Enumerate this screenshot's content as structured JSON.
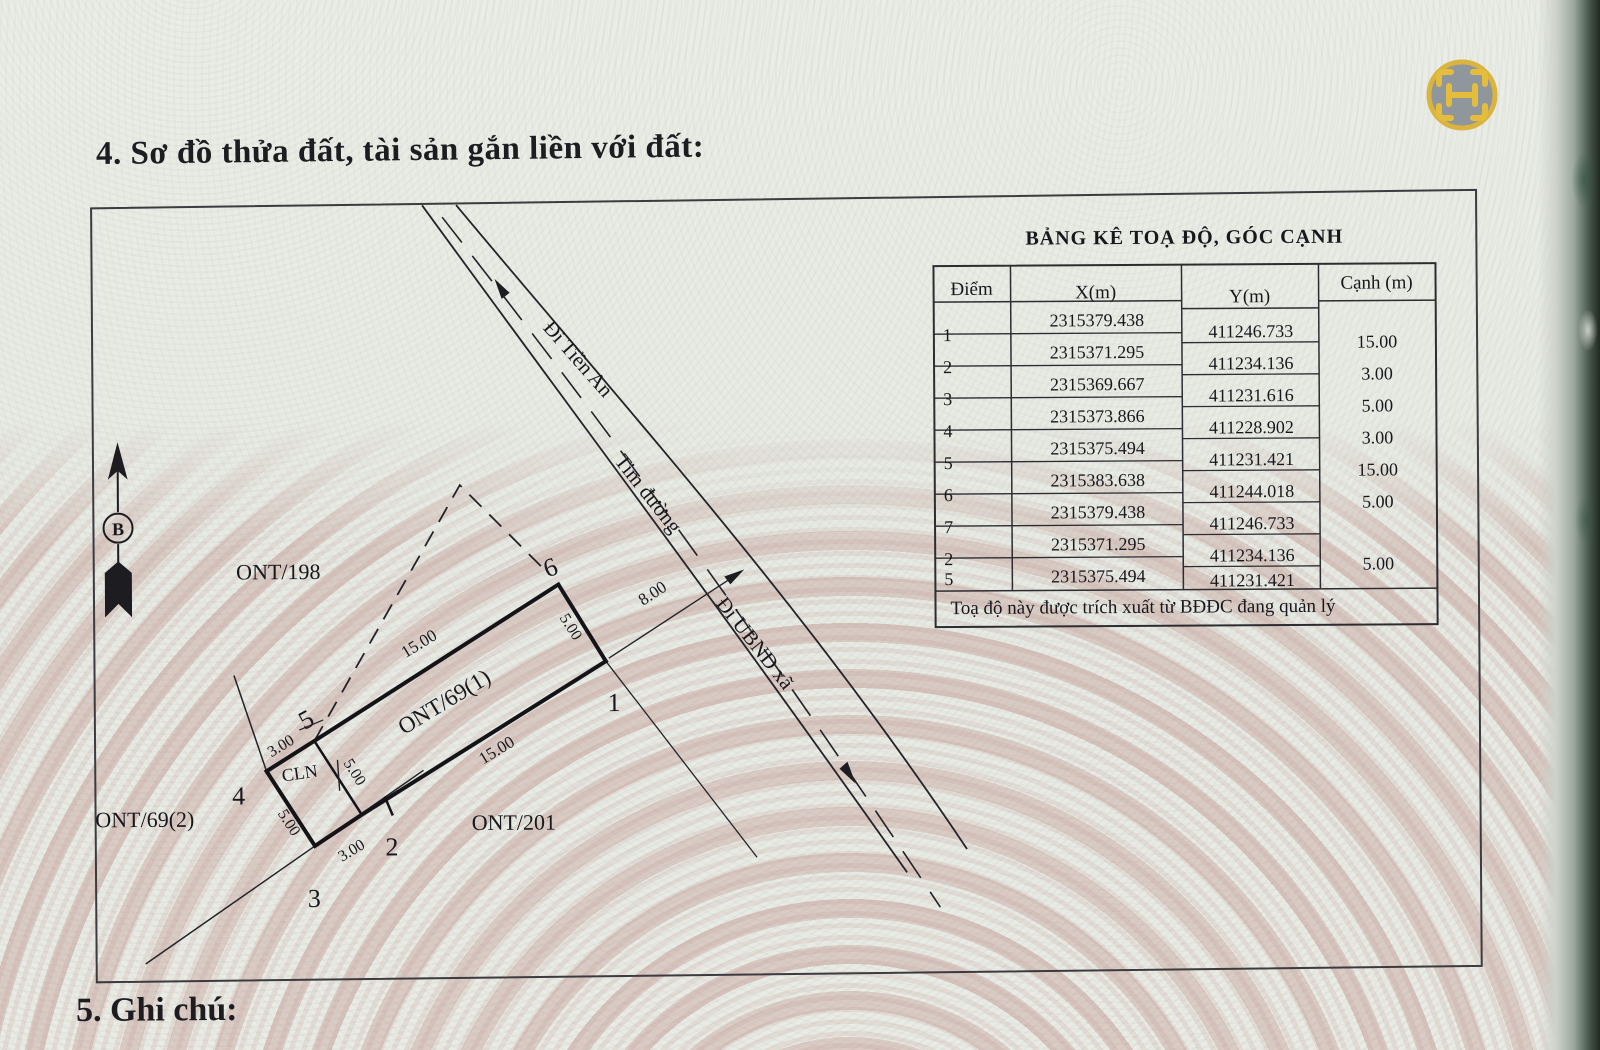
{
  "page": {
    "section4_title": "4. Sơ đồ thửa đất, tài sản gắn liền với đất:",
    "section5_title": "5. Ghi chú:"
  },
  "logo": {
    "glyph_name": "scan-frame-H"
  },
  "compass": {
    "north_label": "B"
  },
  "diagram": {
    "parcels": {
      "ont198": "ONT/198",
      "ont69_1": "ONT/69(1)",
      "ont69_2": "ONT/69(2)",
      "ont201": "ONT/201",
      "cln": "CLN"
    },
    "roads": {
      "di_tien_an": "Đi Tiền An",
      "tim_duong": "Tim đường",
      "di_ubnd_xa": "Đi UBND xã"
    },
    "dims": {
      "side_5_6": "15.00",
      "side_1_2": "15.00",
      "side_6_1": "5.00",
      "side_2_5": "5.00",
      "side_3_4": "5.00",
      "side_4_5": "3.00",
      "side_2_3": "3.00",
      "setback": "8.00"
    },
    "vertices": {
      "v1": "1",
      "v2": "2",
      "v3": "3",
      "v4": "4",
      "v5": "5",
      "v6": "6"
    }
  },
  "table": {
    "title": "BẢNG KÊ TOẠ ĐỘ, GÓC CẠNH",
    "columns": [
      "Điểm",
      "X(m)",
      "Y(m)",
      "Cạnh (m)"
    ],
    "rows": [
      {
        "diem": "1",
        "x": "2315379.438",
        "y": "411246.733"
      },
      {
        "diem": "2",
        "x": "2315371.295",
        "y": "411234.136"
      },
      {
        "diem": "3",
        "x": "2315369.667",
        "y": "411231.616"
      },
      {
        "diem": "4",
        "x": "2315373.866",
        "y": "411228.902"
      },
      {
        "diem": "5",
        "x": "2315375.494",
        "y": "411231.421"
      },
      {
        "diem": "6",
        "x": "2315383.638",
        "y": "411244.018"
      },
      {
        "diem": "7",
        "x": "2315379.438",
        "y": "411246.733"
      },
      {
        "diem": "2",
        "x": "2315371.295",
        "y": "411234.136"
      },
      {
        "diem": "5",
        "x": "2315375.494",
        "y": "411231.421"
      }
    ],
    "edge_lengths": [
      "15.00",
      "3.00",
      "5.00",
      "3.00",
      "15.00",
      "5.00",
      "5.00"
    ],
    "note": "Toạ độ này được trích xuất từ BĐĐC đang quản lý"
  },
  "colors": {
    "paper": "#e9ece5",
    "ink": "#1c1c21",
    "watermark_pink": "#c79a94",
    "logo_gold": "#d9b43f",
    "logo_gray": "#8f969c"
  }
}
